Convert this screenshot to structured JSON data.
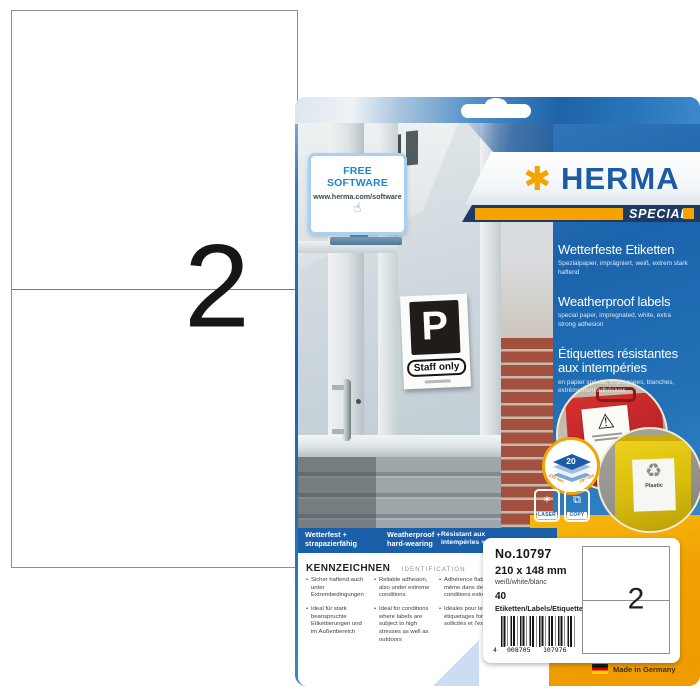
{
  "sheet_preview": {
    "count": "2"
  },
  "package": {
    "free_software": {
      "title": "FREE SOFTWARE",
      "url": "www.herma.com/software",
      "hand_icon": "☝"
    },
    "door_sign": {
      "letter": "P",
      "caption": "Staff only"
    },
    "brand": {
      "logo_text": "HERMA",
      "asterisk_icon": "✱",
      "series_label": "SPECIAL"
    },
    "headline": {
      "de_title": "Wetterfeste Etiketten",
      "de_sub": "Spezialpapier, imprägniert, weiß, extrem stark haftend",
      "en_title": "Weatherproof labels",
      "en_sub": "special paper, impregnated, white, extra strong adhesion",
      "fr_title": "Étiquettes résistantes aux intempéries",
      "fr_sub": "en papier spécial, imprégnées, blanches, extrêmement adhésives"
    },
    "sheet_badge": {
      "count": "20",
      "dim_left": "210 mm",
      "dim_right": "297 mm"
    },
    "print_icons": {
      "laser_label": "LASER",
      "laser_icon": "✶",
      "copy_label": "COPY",
      "copy_icon": "⧉"
    },
    "photo_badges": {
      "warning_icon": "⚠",
      "recycle_icon": "♻",
      "bin_label": "Plastic"
    },
    "feature_strip": [
      "Wetterfest + strapazierfähig",
      "Weatherproof + hard-wearing",
      "Résistant aux intempéries + robustes"
    ],
    "identification": {
      "title_de": "KENNZEICHNEN",
      "title_en": "IDENTIFICATION",
      "columns": [
        {
          "items": [
            "Sicher haftend auch unter Extrembedingungen",
            "Ideal für stark beanspruchte Etikettierungen und im Außenbereich"
          ]
        },
        {
          "items": [
            "Reliable adhesion, also under extreme conditions",
            "Ideal for conditions where labels are subject to high stresses as well as outdoors"
          ]
        },
        {
          "items": [
            "Adhérence fiable même dans des conditions extrêmes",
            "Idéales pour les étiquetages fortement sollicités et l'extérieur"
          ]
        }
      ]
    },
    "info_card": {
      "product_no": "No.10797",
      "dimensions": "210 x 148 mm",
      "colour": "weiß/white/blanc",
      "quantity": "40",
      "quantity_unit": "Etiketten/Labels/Etiquettes",
      "barcode_lead": "4",
      "barcode_group1": "008705",
      "barcode_group2": "107976",
      "diagram_count": "2"
    },
    "made_in": "Made in Germany"
  },
  "colors": {
    "herma_blue": "#1d5ba4",
    "herma_orange": "#f6a300",
    "navy_band": "#1c3a63",
    "panel_blue": "#1b63ac",
    "strip_blue": "#1b5fa8",
    "accent_yellow": "#f1a102",
    "case_red": "#c2262a",
    "bin_yellow": "#d9bd0e"
  }
}
